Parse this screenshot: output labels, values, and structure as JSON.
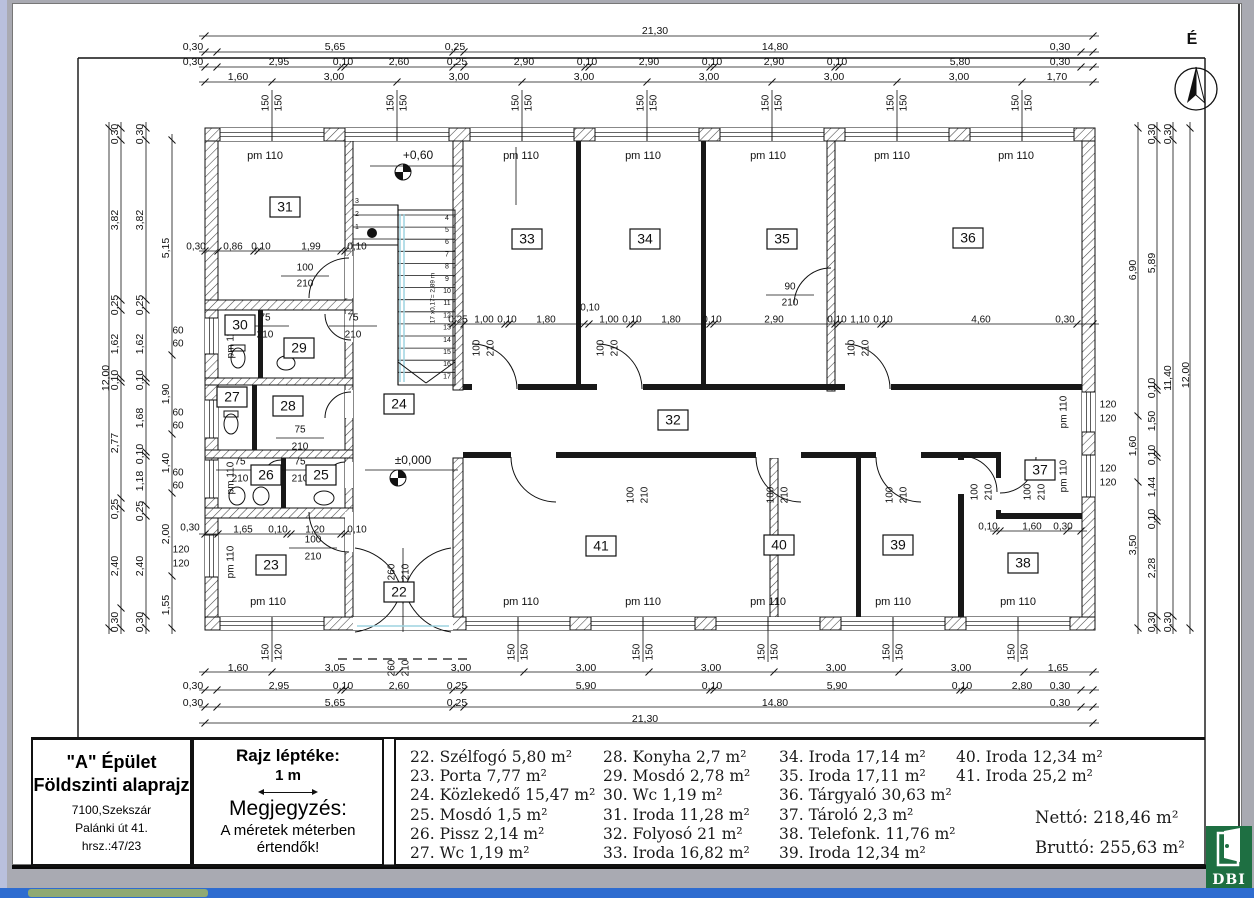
{
  "compass": {
    "north_label": "É"
  },
  "title_block": {
    "building": "\"A\" Épület",
    "drawing": "Földszinti alaprajz",
    "address1": "7100,Szekszár",
    "address2": "Palánki út 41.",
    "address3": "hrsz.:47/23",
    "scale_title": "Rajz léptéke:",
    "scale_value": "1 m",
    "note_title": "Megjegyzés:",
    "note_line1": "A méretek méterben",
    "note_line2": "értendők!"
  },
  "legend": {
    "columns": [
      [
        "22. Szélfogó 5,80 m²",
        "23. Porta 7,77 m²",
        "24. Közlekedő 15,47 m²",
        "25. Mosdó 1,5 m²",
        "26. Pissz 2,14 m²",
        "27. Wc 1,19 m²"
      ],
      [
        "28. Konyha 2,7 m²",
        "29. Mosdó 2,78 m²",
        "30. Wc 1,19 m²",
        "31. Iroda 11,28 m²",
        "32. Folyosó 21 m²",
        "33. Iroda 16,82 m²"
      ],
      [
        "34. Iroda 17,14 m²",
        "35. Iroda 17,11 m²",
        "36. Tárgyaló 30,63 m²",
        "37. Tároló 2,3 m²",
        "38. Telefonk. 11,76 m²",
        "39. Iroda 12,34 m²"
      ],
      [
        "40. Iroda 12,34 m²",
        "41. Iroda 25,2 m²"
      ]
    ],
    "column_x": [
      7,
      200,
      376,
      553
    ],
    "netto": "Nettó: 218,46 m²",
    "brutto": "Bruttó: 255,63 m²"
  },
  "logo": {
    "text": "DBI",
    "color": "#1e6f42"
  },
  "plan": {
    "levels": [
      [
        "+0,60",
        418,
        156
      ],
      [
        "±0,000",
        413,
        461
      ]
    ],
    "room_numbers": [
      [
        "31",
        285,
        207
      ],
      [
        "30",
        240,
        325
      ],
      [
        "29",
        299,
        348
      ],
      [
        "27",
        232,
        397
      ],
      [
        "28",
        288,
        406
      ],
      [
        "24",
        399,
        404
      ],
      [
        "26",
        266,
        475
      ],
      [
        "25",
        321,
        475
      ],
      [
        "23",
        271,
        565
      ],
      [
        "22",
        399,
        592
      ],
      [
        "33",
        527,
        239
      ],
      [
        "34",
        645,
        239
      ],
      [
        "35",
        782,
        239
      ],
      [
        "36",
        968,
        238
      ],
      [
        "32",
        673,
        420
      ],
      [
        "41",
        601,
        546
      ],
      [
        "40",
        779,
        545
      ],
      [
        "39",
        898,
        545
      ],
      [
        "37",
        1040,
        470
      ],
      [
        "38",
        1023,
        563
      ]
    ],
    "pm_labels": [
      [
        "pm 110",
        265,
        156
      ],
      [
        "pm 110",
        521,
        156
      ],
      [
        "pm 110",
        643,
        156
      ],
      [
        "pm 110",
        768,
        156
      ],
      [
        "pm 110",
        892,
        156
      ],
      [
        "pm 110",
        1016,
        156
      ],
      [
        "pm 110",
        268,
        602
      ],
      [
        "pm 110",
        521,
        602
      ],
      [
        "pm 110",
        643,
        602
      ],
      [
        "pm 110",
        768,
        602
      ],
      [
        "pm 110",
        893,
        602
      ],
      [
        "pm 110",
        1018,
        602
      ]
    ],
    "dims_top": [
      [
        "21,30",
        655,
        31
      ],
      [
        "0,30",
        193,
        47
      ],
      [
        "5,65",
        335,
        47
      ],
      [
        "0,25",
        455,
        47
      ],
      [
        "14,80",
        775,
        47
      ],
      [
        "0,30",
        1060,
        47
      ],
      [
        "0,30",
        193,
        62
      ],
      [
        "2,95",
        279,
        62
      ],
      [
        "0,10",
        343,
        62
      ],
      [
        "2,60",
        399,
        62
      ],
      [
        "0,25",
        457,
        62
      ],
      [
        "2,90",
        524,
        62
      ],
      [
        "0,10",
        587,
        62
      ],
      [
        "2,90",
        649,
        62
      ],
      [
        "0,10",
        712,
        62
      ],
      [
        "2,90",
        774,
        62
      ],
      [
        "0,10",
        837,
        62
      ],
      [
        "5,80",
        960,
        62
      ],
      [
        "0,30",
        1060,
        62
      ],
      [
        "1,60",
        238,
        77
      ],
      [
        "3,00",
        334,
        77
      ],
      [
        "3,00",
        459,
        77
      ],
      [
        "3,00",
        584,
        77
      ],
      [
        "3,00",
        709,
        77
      ],
      [
        "3,00",
        834,
        77
      ],
      [
        "3,00",
        959,
        77
      ],
      [
        "1,70",
        1057,
        77
      ]
    ],
    "dims_bottom": [
      [
        "1,60",
        238,
        668
      ],
      [
        "3,05",
        335,
        668
      ],
      [
        "3,00",
        461,
        668
      ],
      [
        "3,00",
        586,
        668
      ],
      [
        "3,00",
        711,
        668
      ],
      [
        "3,00",
        836,
        668
      ],
      [
        "3,00",
        961,
        668
      ],
      [
        "1,65",
        1058,
        668
      ],
      [
        "0,30",
        193,
        686
      ],
      [
        "2,95",
        279,
        686
      ],
      [
        "0,10",
        343,
        686
      ],
      [
        "2,60",
        399,
        686
      ],
      [
        "0,25",
        457,
        686
      ],
      [
        "5,90",
        586,
        686
      ],
      [
        "0,10",
        712,
        686
      ],
      [
        "5,90",
        837,
        686
      ],
      [
        "0,10",
        962,
        686
      ],
      [
        "2,80",
        1022,
        686
      ],
      [
        "0,30",
        1060,
        686
      ],
      [
        "0,30",
        193,
        703
      ],
      [
        "5,65",
        335,
        703
      ],
      [
        "0,25",
        457,
        703
      ],
      [
        "14,80",
        775,
        703
      ],
      [
        "0,30",
        1060,
        703
      ],
      [
        "21,30",
        645,
        719
      ]
    ],
    "dims_left": [
      [
        "12,00",
        106,
        378
      ],
      [
        "0,30",
        115,
        134
      ],
      [
        "3,82",
        115,
        220
      ],
      [
        "0,25",
        115,
        305
      ],
      [
        "1,62",
        115,
        344
      ],
      [
        "0,10",
        115,
        380
      ],
      [
        "2,77",
        115,
        443
      ],
      [
        "0,25",
        115,
        509
      ],
      [
        "2,40",
        115,
        566
      ],
      [
        "0,30",
        115,
        622
      ],
      [
        "0,30",
        140,
        134
      ],
      [
        "3,82",
        140,
        220
      ],
      [
        "0,25",
        140,
        305
      ],
      [
        "1,62",
        140,
        344
      ],
      [
        "0,10",
        140,
        380
      ],
      [
        "1,68",
        140,
        418
      ],
      [
        "0,10",
        140,
        454
      ],
      [
        "1,18",
        140,
        481
      ],
      [
        "0,25",
        140,
        511
      ],
      [
        "2,40",
        140,
        566
      ],
      [
        "0,30",
        140,
        622
      ],
      [
        "5,15",
        166,
        248
      ],
      [
        "1,90",
        166,
        394
      ],
      [
        "1,40",
        166,
        463
      ],
      [
        "2,00",
        166,
        534
      ],
      [
        "1,55",
        166,
        605
      ]
    ],
    "dims_right": [
      [
        "6,90",
        1133,
        270
      ],
      [
        "1,60",
        1133,
        446
      ],
      [
        "3,50",
        1133,
        545
      ],
      [
        "0,30",
        1152,
        134
      ],
      [
        "5,89",
        1152,
        263
      ],
      [
        "0,10",
        1152,
        388
      ],
      [
        "1,50",
        1152,
        421
      ],
      [
        "0,10",
        1152,
        455
      ],
      [
        "1,44",
        1152,
        487
      ],
      [
        "0,10",
        1152,
        519
      ],
      [
        "2,28",
        1152,
        568
      ],
      [
        "0,30",
        1152,
        622
      ],
      [
        "0,30",
        1168,
        134
      ],
      [
        "11,40",
        1168,
        378
      ],
      [
        "0,30",
        1168,
        622
      ],
      [
        "12,00",
        1186,
        375
      ]
    ],
    "interior_dims": [
      [
        "0,30",
        196,
        247
      ],
      [
        "0,86",
        233,
        247
      ],
      [
        "0,10",
        261,
        247
      ],
      [
        "1,99",
        311,
        247
      ],
      [
        "0,10",
        357,
        247
      ],
      [
        "0,25",
        458,
        320
      ],
      [
        "1,00",
        484,
        320
      ],
      [
        "0,10",
        507,
        320
      ],
      [
        "1,80",
        546,
        320
      ],
      [
        "0,10",
        590,
        308
      ],
      [
        "1,00",
        609,
        320
      ],
      [
        "0,10",
        632,
        320
      ],
      [
        "1,80",
        671,
        320
      ],
      [
        "0,10",
        712,
        320
      ],
      [
        "2,90",
        774,
        320
      ],
      [
        "0,10",
        837,
        320
      ],
      [
        "1,10",
        860,
        320
      ],
      [
        "0,10",
        883,
        320
      ],
      [
        "4,60",
        981,
        320
      ],
      [
        "0,30",
        1065,
        320
      ],
      [
        "1,65",
        243,
        530
      ],
      [
        "0,10",
        278,
        530
      ],
      [
        "1,20",
        315,
        530
      ],
      [
        "0,10",
        357,
        530
      ],
      [
        "0,30",
        190,
        528
      ],
      [
        "0,10",
        988,
        527
      ],
      [
        "1,60",
        1032,
        527
      ],
      [
        "0,30",
        1063,
        527
      ]
    ],
    "window_labels": [
      [
        "150",
        266,
        103,
        -90
      ],
      [
        "150",
        279,
        103,
        -90
      ],
      [
        "150",
        391,
        103,
        -90
      ],
      [
        "150",
        404,
        103,
        -90
      ],
      [
        "150",
        516,
        103,
        -90
      ],
      [
        "150",
        529,
        103,
        -90
      ],
      [
        "150",
        641,
        103,
        -90
      ],
      [
        "150",
        654,
        103,
        -90
      ],
      [
        "150",
        766,
        103,
        -90
      ],
      [
        "150",
        779,
        103,
        -90
      ],
      [
        "150",
        891,
        103,
        -90
      ],
      [
        "150",
        904,
        103,
        -90
      ],
      [
        "150",
        1016,
        103,
        -90
      ],
      [
        "150",
        1029,
        103,
        -90
      ],
      [
        "150",
        266,
        652,
        -90
      ],
      [
        "120",
        279,
        652,
        -90
      ],
      [
        "150",
        512,
        652,
        -90
      ],
      [
        "150",
        525,
        652,
        -90
      ],
      [
        "150",
        637,
        652,
        -90
      ],
      [
        "150",
        650,
        652,
        -90
      ],
      [
        "150",
        762,
        652,
        -90
      ],
      [
        "150",
        775,
        652,
        -90
      ],
      [
        "150",
        887,
        652,
        -90
      ],
      [
        "150",
        900,
        652,
        -90
      ],
      [
        "150",
        1012,
        652,
        -90
      ],
      [
        "150",
        1025,
        652,
        -90
      ],
      [
        "60",
        178,
        331,
        0
      ],
      [
        "60",
        178,
        344,
        0
      ],
      [
        "60",
        178,
        413,
        0
      ],
      [
        "60",
        178,
        426,
        0
      ],
      [
        "60",
        178,
        473,
        0
      ],
      [
        "60",
        178,
        486,
        0
      ],
      [
        "120",
        181,
        550,
        0
      ],
      [
        "120",
        181,
        564,
        0
      ],
      [
        "120",
        1108,
        405,
        0
      ],
      [
        "120",
        1108,
        419,
        0
      ],
      [
        "120",
        1108,
        469,
        0
      ],
      [
        "120",
        1108,
        483,
        0
      ],
      [
        "pm 110",
        231,
        342,
        -90
      ],
      [
        "pm 110",
        231,
        478,
        -90
      ],
      [
        "pm 110",
        231,
        562,
        -90
      ],
      [
        "pm 110",
        1064,
        412,
        -90
      ],
      [
        "pm 110",
        1064,
        476,
        -90
      ]
    ],
    "door_labels": [
      [
        "100",
        305,
        268
      ],
      [
        "210",
        305,
        284
      ],
      [
        "100",
        313,
        540
      ],
      [
        "210",
        313,
        557
      ],
      [
        "75",
        265,
        318
      ],
      [
        "210",
        265,
        335
      ],
      [
        "75",
        353,
        318
      ],
      [
        "210",
        353,
        335
      ],
      [
        "75",
        300,
        430
      ],
      [
        "210",
        300,
        447
      ],
      [
        "75",
        240,
        462
      ],
      [
        "210",
        240,
        479
      ],
      [
        "75",
        300,
        462
      ],
      [
        "210",
        300,
        479
      ],
      [
        "90",
        790,
        287
      ],
      [
        "210",
        790,
        303
      ],
      [
        "100",
        477,
        348,
        -90
      ],
      [
        "210",
        491,
        348,
        -90
      ],
      [
        "100",
        601,
        348,
        -90
      ],
      [
        "210",
        615,
        348,
        -90
      ],
      [
        "100",
        852,
        348,
        -90
      ],
      [
        "210",
        866,
        348,
        -90
      ],
      [
        "100",
        631,
        495,
        -90
      ],
      [
        "210",
        645,
        495,
        -90
      ],
      [
        "100",
        771,
        495,
        -90
      ],
      [
        "210",
        785,
        495,
        -90
      ],
      [
        "100",
        890,
        495,
        -90
      ],
      [
        "210",
        904,
        495,
        -90
      ],
      [
        "100",
        975,
        492,
        -90
      ],
      [
        "210",
        989,
        492,
        -90
      ],
      [
        "100",
        1028,
        492,
        -90
      ],
      [
        "210",
        1042,
        492,
        -90
      ],
      [
        "260",
        392,
        572,
        -90
      ],
      [
        "210",
        406,
        572,
        -90
      ],
      [
        "260",
        392,
        668,
        -90
      ],
      [
        "210",
        406,
        668,
        -90
      ]
    ],
    "stairs": {
      "steps": [
        "1",
        "2",
        "3",
        "4",
        "5",
        "6",
        "7",
        "8",
        "9",
        "10",
        "11",
        "12",
        "13",
        "14",
        "15",
        "16",
        "17"
      ],
      "formula": "17 x0,17= 2,89 m"
    }
  }
}
